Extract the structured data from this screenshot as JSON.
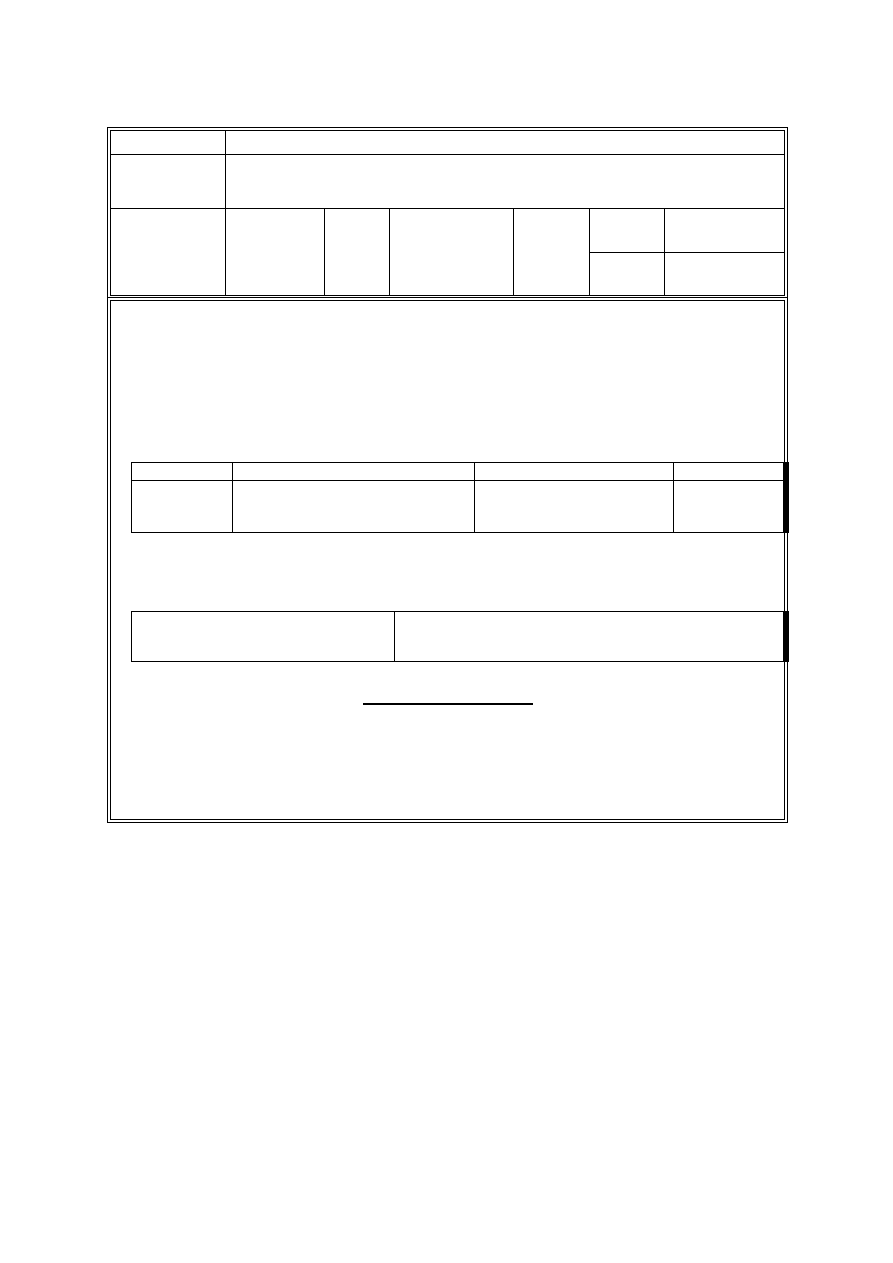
{
  "page": {
    "background": "#ffffff",
    "line_color": "#000000",
    "content": "blank form template, no visible text"
  },
  "header_table": {
    "row1": {
      "label_cell": "",
      "value_cell": ""
    },
    "row2": {
      "label_cell": "",
      "value_cell": ""
    },
    "row3": {
      "col1": "",
      "col2": "",
      "col3": "",
      "col4": "",
      "col5": "",
      "col6_top": "",
      "col7_top": "",
      "col6_bottom": "",
      "col7_bottom": ""
    }
  },
  "main_section": {
    "details_table": {
      "header_row": {
        "col1": "",
        "col2": "",
        "col3": "",
        "col4": ""
      },
      "data_row": {
        "col1": "",
        "col2": "",
        "col3": "",
        "col4": ""
      }
    },
    "two_column_table": {
      "left_cell": "",
      "right_cell": ""
    },
    "signature_line": {
      "text": ""
    }
  }
}
